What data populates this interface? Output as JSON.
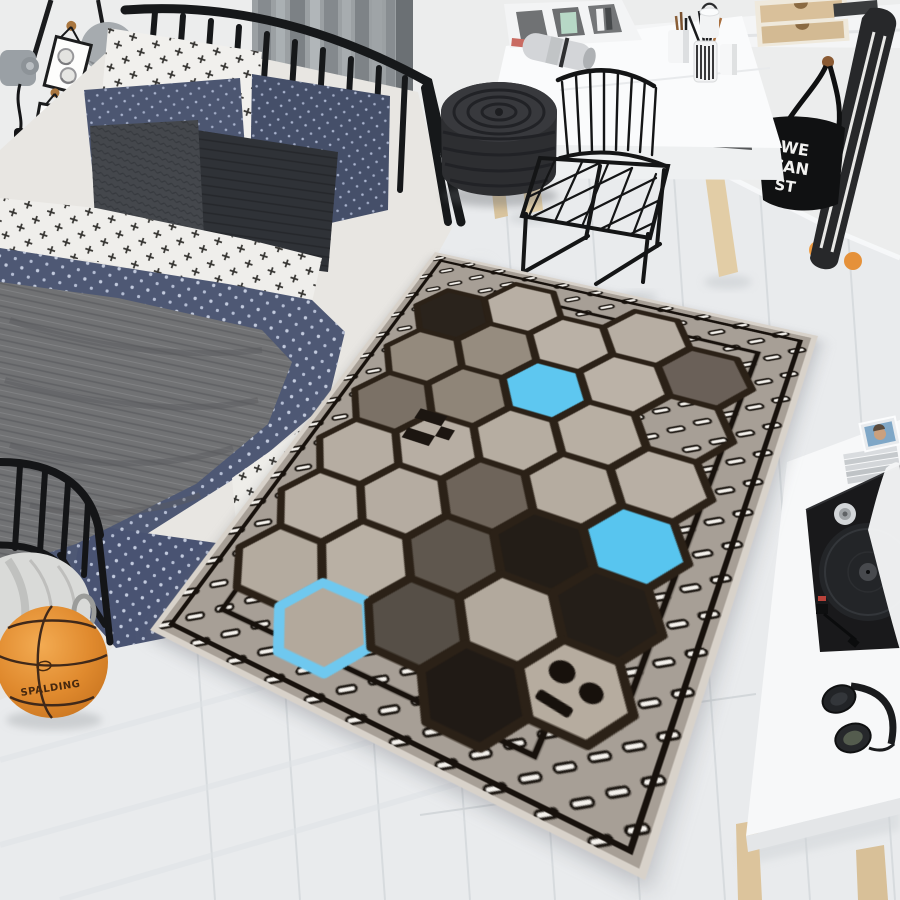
{
  "scene": {
    "description": "Top-down view of a teen bedroom: black metal bed with navy bedding, white desk with black wire chair, knitted pouf, longboard, tote bag, basketball, duffel bag, record player side table, and a gray hexagon-pattern rug with blue accent hexagons, an alien face and pixel motifs"
  },
  "palette": {
    "floor": "#e9ebed",
    "wall": "#eceded",
    "curtain_gray": "#9ba0a3",
    "metal_black": "#17181a",
    "bed_navy": "#4e5874",
    "bed_white": "#f1f0ed",
    "blanket_gray": "#717274",
    "pouf_charcoal": "#2d2e31",
    "desk_white": "#fafbfc",
    "wood_light": "#e2cda6",
    "basketball_orange": "#e08a2e",
    "rug_background": "#a79f96",
    "rug_beige": "#b7aea3",
    "rug_taupe": "#948a7d",
    "rug_dark": "#5f574e",
    "rug_black": "#241e18",
    "rug_blue": "#5ec7f0"
  },
  "objects": {
    "basketball": {
      "brand": "SPALDING"
    },
    "tote_bag": {
      "lines": [
        "WE",
        "CAN",
        "ST"
      ]
    }
  },
  "rug": {
    "background": "#a79f96",
    "hex_border": "#2b2117",
    "blue": "#5ec7f0",
    "hexes": [
      {
        "x": 64,
        "y": 96,
        "fill": "#2a231c"
      },
      {
        "x": 64,
        "y": 168,
        "fill": "#948a7d"
      },
      {
        "x": 64,
        "y": 240,
        "fill": "#7b7166"
      },
      {
        "x": 64,
        "y": 312,
        "fill": "#b6ada2"
      },
      {
        "x": 64,
        "y": 384,
        "fill": "#b9b0a5"
      },
      {
        "x": 64,
        "y": 456,
        "fill": "#b4ab9f"
      },
      {
        "x": 128,
        "y": 60,
        "fill": "#b8afa4"
      },
      {
        "x": 128,
        "y": 132,
        "fill": "#968c7f"
      },
      {
        "x": 128,
        "y": 204,
        "fill": "#8f8578"
      },
      {
        "x": 128,
        "y": 276,
        "fill": "#b7aea3"
      },
      {
        "x": 128,
        "y": 348,
        "fill": "#b5aca1"
      },
      {
        "x": 128,
        "y": 420,
        "fill": "#b9b0a4"
      },
      {
        "x": 128,
        "y": 492,
        "fill": "#b3a99c",
        "outline": "#6fc8ef"
      },
      {
        "x": 192,
        "y": 96,
        "fill": "#bab1a6"
      },
      {
        "x": 192,
        "y": 168,
        "fill": "#5ec7f0"
      },
      {
        "x": 192,
        "y": 240,
        "fill": "#b6ada1"
      },
      {
        "x": 192,
        "y": 312,
        "fill": "#6e645a"
      },
      {
        "x": 192,
        "y": 384,
        "fill": "#5f574e"
      },
      {
        "x": 192,
        "y": 456,
        "fill": "#564f47"
      },
      {
        "x": 256,
        "y": 60,
        "fill": "#b7aea3"
      },
      {
        "x": 256,
        "y": 132,
        "fill": "#bbb2a7"
      },
      {
        "x": 256,
        "y": 204,
        "fill": "#b8afa3"
      },
      {
        "x": 256,
        "y": 276,
        "fill": "#b5aca0"
      },
      {
        "x": 256,
        "y": 348,
        "fill": "#231d17"
      },
      {
        "x": 256,
        "y": 420,
        "fill": "#b2a99d"
      },
      {
        "x": 256,
        "y": 492,
        "fill": "#201a15"
      },
      {
        "x": 320,
        "y": 96,
        "fill": "#6a6058"
      },
      {
        "x": 320,
        "y": 168,
        "fill": "dash"
      },
      {
        "x": 320,
        "y": 240,
        "fill": "#b8afa4"
      },
      {
        "x": 320,
        "y": 312,
        "fill": "#58c5ef"
      },
      {
        "x": 320,
        "y": 384,
        "fill": "#241e18"
      },
      {
        "x": 320,
        "y": 456,
        "fill": "#b6ac9f"
      }
    ]
  }
}
